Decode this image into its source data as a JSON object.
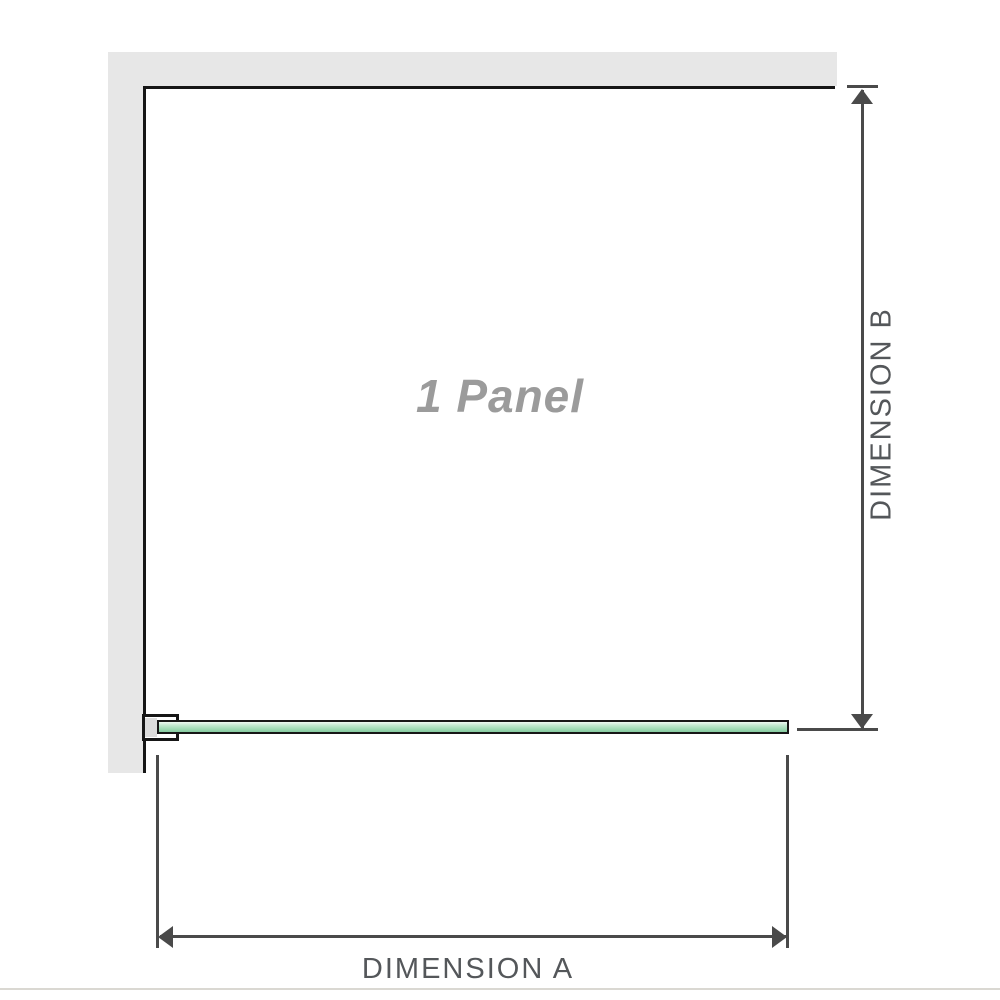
{
  "diagram": {
    "panel_label": "1 Panel",
    "dimension_a": {
      "label": "DIMENSION A",
      "orientation": "horizontal"
    },
    "dimension_b": {
      "label": "DIMENSION B",
      "orientation": "vertical"
    }
  },
  "colors": {
    "wall": "#e7e7e7",
    "panel_border": "#161616",
    "panel_text": "#9b9b9b",
    "glass_top": "#eef8f1",
    "glass_bottom": "#86cba0",
    "glass_border": "#161616",
    "bracket_pad": "#dcdcdc",
    "dimension_line": "#4a4a4a",
    "label_text": "#54575a",
    "footer_line": "#dad8d2"
  }
}
